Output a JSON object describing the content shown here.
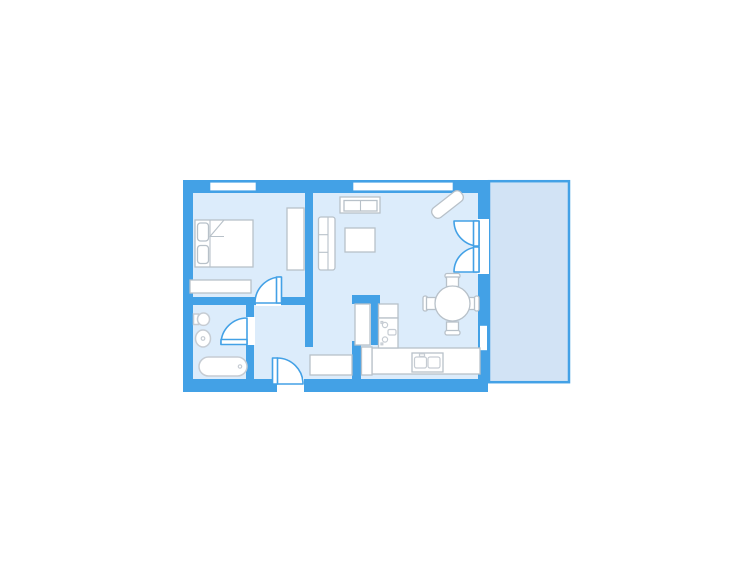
{
  "page": {
    "background": "#ffffff",
    "kind": "apartment-floor-plan"
  },
  "colors": {
    "page_bg": "#ffffff",
    "wall": "#43a1e6",
    "floor": "#dcecfb",
    "balcony_floor": "#d2e3f5",
    "opening_fill": "#ffffff",
    "furniture_fill": "#ffffff",
    "furniture_stroke": "#b8c1c9",
    "fixture_stroke": "#c6ccd3"
  },
  "plan": {
    "rooms": [
      {
        "id": "bedroom",
        "position": "top-left"
      },
      {
        "id": "bathroom",
        "position": "bottom-left"
      },
      {
        "id": "hallway",
        "position": "bottom-center-left"
      },
      {
        "id": "living-dining",
        "position": "center-right"
      },
      {
        "id": "kitchen-nook",
        "position": "bottom-center-right"
      },
      {
        "id": "balcony",
        "position": "right-strip"
      }
    ],
    "windows": [
      "bedroom-top-window",
      "living-top-window",
      "dining-right-window"
    ],
    "doors": [
      {
        "id": "bedroom-door",
        "type": "single-swing"
      },
      {
        "id": "bathroom-door",
        "type": "single-swing"
      },
      {
        "id": "entrance-door",
        "type": "single-swing"
      },
      {
        "id": "balcony-door",
        "type": "double-french"
      }
    ],
    "furniture": {
      "bedroom": [
        "double-bed",
        "pillows-x2",
        "blanket-fold",
        "wardrobe",
        "dresser"
      ],
      "bathroom": [
        "toilet",
        "washbasin",
        "bathtub"
      ],
      "living": [
        "tv-sideboard",
        "sofa",
        "coffee-table",
        "diagonal-shelf",
        "entry-bench"
      ],
      "kitchen": [
        "tall-cabinet",
        "lower-cabinet",
        "upper-cabinet",
        "stove",
        "counter",
        "double-sink"
      ],
      "dining": [
        "round-table",
        "chair-north",
        "chair-south",
        "chair-east",
        "chair-west"
      ]
    }
  }
}
